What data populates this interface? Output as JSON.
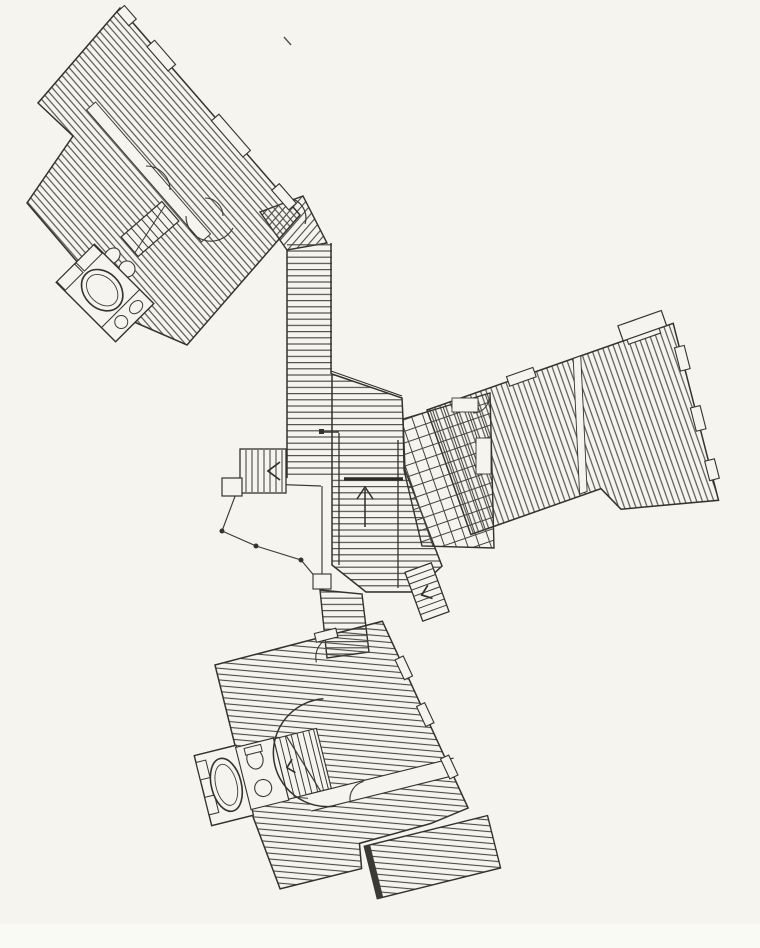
{
  "document": {
    "type": "Scanned architectural drawing",
    "title": "Floor plan: three rotated wings joined by boardwalk corridors to a central entry deck",
    "aria_label": "Black and white scanned floor plan of a building with three hatched wings, connecting corridors, central deck with entry arrow, bathrooms with tubs, and stairs"
  },
  "palette": {
    "paper": "#f5f4ee",
    "ink": "#33322d",
    "hatch_line": "#4a4943",
    "scan_edge_strip": "#fafaf5"
  },
  "plan": {
    "center_deck": {
      "label": "central entry deck",
      "markers": [
        "entry-arrow-up",
        "threshold-bar",
        "side-stair-left",
        "side-stair-right",
        "fan-terrace-with-posts"
      ]
    },
    "wings": [
      {
        "label": "northwest wing",
        "angle_deg": 49,
        "features": [
          "board-hatched rooms",
          "bathroom pod with tub",
          "staircase",
          "door swings",
          "window openings"
        ]
      },
      {
        "label": "east wing",
        "angle_deg": -19,
        "features": [
          "board-hatched rooms",
          "gridded sunroom",
          "room divider",
          "window openings",
          "balcony stub"
        ]
      },
      {
        "label": "south wing",
        "angle_deg": -14,
        "features": [
          "board-hatched rooms",
          "bathroom pod with tub",
          "staircase with break line",
          "curved wall",
          "hallway",
          "detached lower deck"
        ]
      }
    ],
    "corridors": [
      {
        "label": "north boardwalk corridor"
      },
      {
        "label": "south boardwalk connector"
      }
    ]
  }
}
